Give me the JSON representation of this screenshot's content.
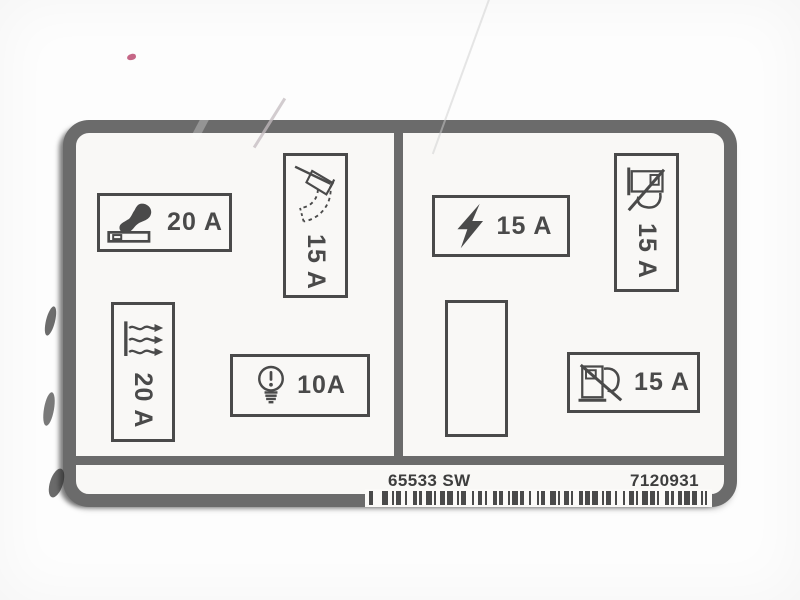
{
  "label_type": "vehicle-fuse-box-diagram-sticker",
  "colors": {
    "border": "#6b6b6b",
    "ink": "#4a4a4a",
    "label_bg": "#f9f8f6",
    "footer_ink": "#3e3e3e"
  },
  "cells": {
    "lighter": {
      "amp": "20 A",
      "icon": "cigarette-lighter-icon"
    },
    "wiper": {
      "amp": "15 A",
      "icon": "windscreen-wiper-icon"
    },
    "heater": {
      "amp": "20 A",
      "icon": "heater-blower-icon"
    },
    "bulb": {
      "amp": "10A",
      "icon": "light-bulb-icon"
    },
    "bolt": {
      "amp": "15 A",
      "icon": "lightning-bolt-icon"
    },
    "pump_top": {
      "amp": "15 A",
      "icon": "fuel-pump-icon"
    },
    "empty": {
      "amp": ""
    },
    "pump_bottom": {
      "amp": "15 A",
      "icon": "fuel-pump-icon"
    }
  },
  "footer": {
    "part_number": "65533 SW",
    "serial_number": "7120931"
  },
  "barcode": {
    "pattern": [
      2,
      4,
      3,
      2,
      1,
      1,
      2,
      2,
      1,
      3,
      2,
      1,
      1,
      2,
      3,
      1,
      1,
      2,
      2,
      1,
      3,
      2,
      1,
      1,
      2,
      3,
      1,
      2,
      2,
      1,
      1,
      3,
      2,
      1,
      2,
      2,
      1,
      1,
      3,
      1,
      2,
      2,
      1,
      3,
      1,
      1,
      2,
      2,
      3,
      1,
      1,
      2,
      2,
      1,
      1,
      3,
      2,
      1,
      2,
      1,
      3,
      2,
      1,
      1,
      2,
      2,
      1,
      3,
      1,
      2,
      2,
      1,
      1,
      2,
      3,
      1,
      2,
      1,
      1,
      3,
      2,
      1,
      1,
      2,
      2,
      1,
      3,
      1,
      2,
      2,
      1,
      1,
      1
    ]
  }
}
